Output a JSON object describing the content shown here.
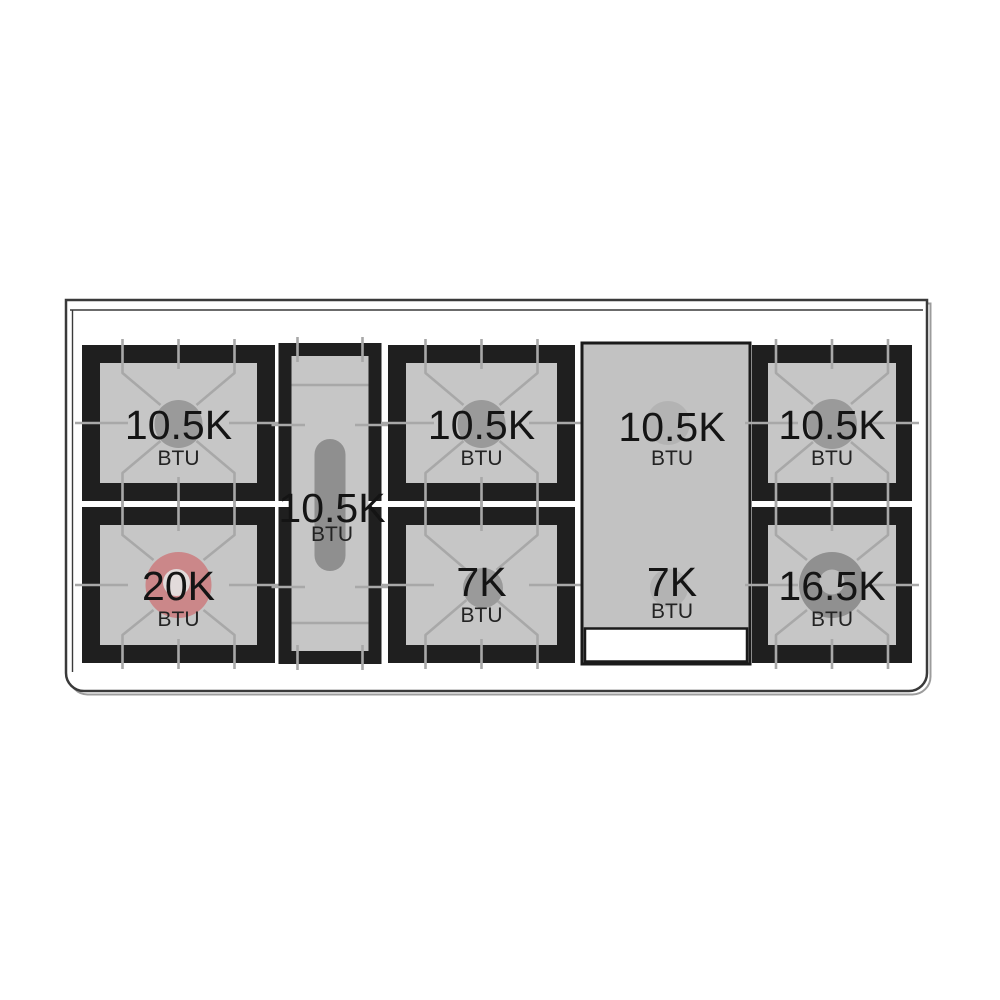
{
  "burners": {
    "left_top": {
      "value": "10.5K",
      "unit": "BTU"
    },
    "left_bottom": {
      "value": "20K",
      "unit": "BTU"
    },
    "oval_center": {
      "value": "10.5K",
      "unit": "BTU"
    },
    "middle_top": {
      "value": "10.5K",
      "unit": "BTU"
    },
    "middle_bottom": {
      "value": "7K",
      "unit": "BTU"
    },
    "griddle_top": {
      "value": "10.5K",
      "unit": "BTU"
    },
    "griddle_bottom": {
      "value": "7K",
      "unit": "BTU"
    },
    "right_top": {
      "value": "10.5K",
      "unit": "BTU"
    },
    "right_bottom": {
      "value": "16.5K",
      "unit": "BTU"
    }
  },
  "colors": {
    "highlight_burner_pink": "#cb8789",
    "grate_frame_black": "#1f1f1f",
    "grate_surface_gray": "#c6c6c6",
    "burner_gray": "#9a9a9a",
    "griddle_surface_gray": "#c2c2c2"
  }
}
